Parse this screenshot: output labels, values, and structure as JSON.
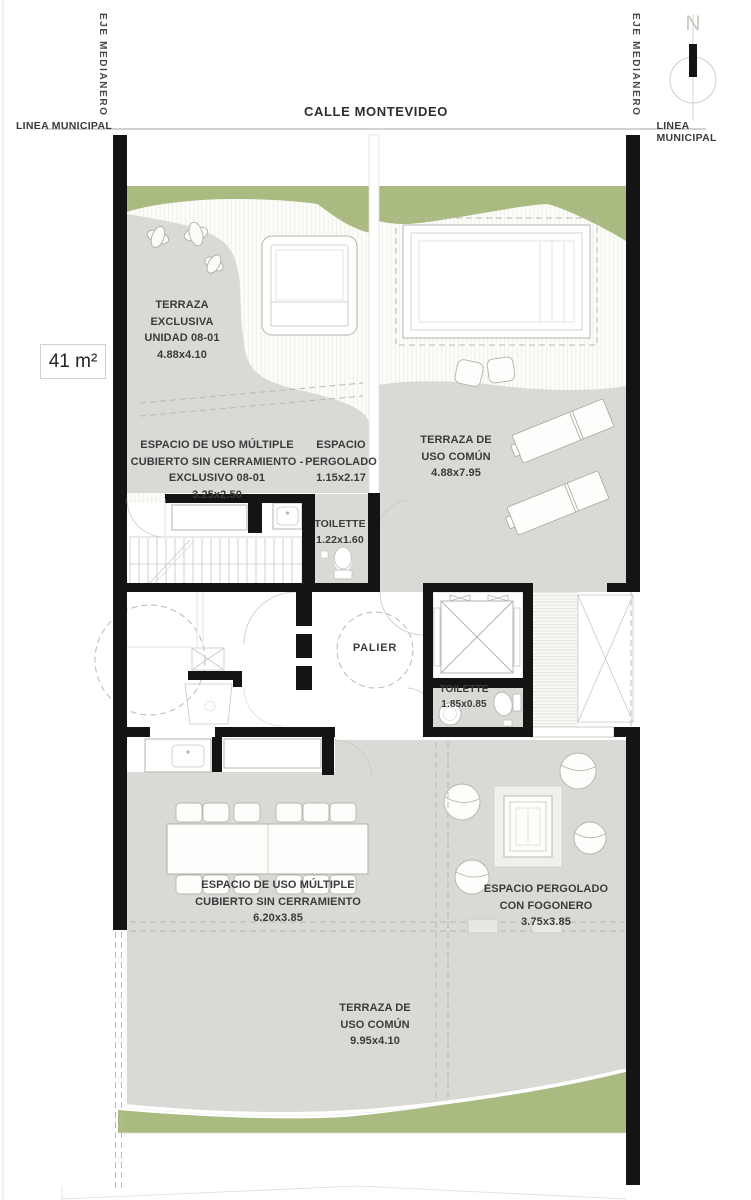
{
  "colors": {
    "wall": "#141414",
    "green": "#a9bb80",
    "terrace": "#d9d9d6",
    "line": "#b4b4ae",
    "text": "#3b3b3b"
  },
  "site": {
    "street": "CALLE MONTEVIDEO",
    "municipal_line_left": "LINEA MUNICIPAL",
    "municipal_line_right": "LINEA MUNICIPAL",
    "party_axis_left": "EJE MEDIANERO",
    "party_axis_right": "EJE MEDIANERO",
    "north_letter": "N",
    "area_badge": "41 m²"
  },
  "rooms": {
    "terraza_exclusiva": "TERRAZA\nEXCLUSIVA\nUNIDAD 08-01\n4.88x4.10",
    "uso_multiple_exclusivo": "ESPACIO DE USO MÚLTIPLE\nCUBIERTO SIN CERRAMIENTO -\nEXCLUSIVO 08-01\n3.25x2.50",
    "pergolado_upper": "ESPACIO\nPERGOLADO\n1.15x2.17",
    "toilette_upper": "TOILETTE\n1.22x1.60",
    "terraza_comun_upper": "TERRAZA DE\nUSO COMÚN\n4.88x7.95",
    "palier": "PALIER",
    "toilette_lower": "TOILETTE\n1.85x0.85",
    "uso_multiple_comun": "ESPACIO DE USO MÚLTIPLE\nCUBIERTO SIN CERRAMIENTO\n6.20x3.85",
    "pergolado_fogonero": "ESPACIO PERGOLADO\nCON FOGONERO\n3.75x3.85",
    "terraza_comun_lower": "TERRAZA DE\nUSO COMÚN\n9.95x4.10"
  }
}
